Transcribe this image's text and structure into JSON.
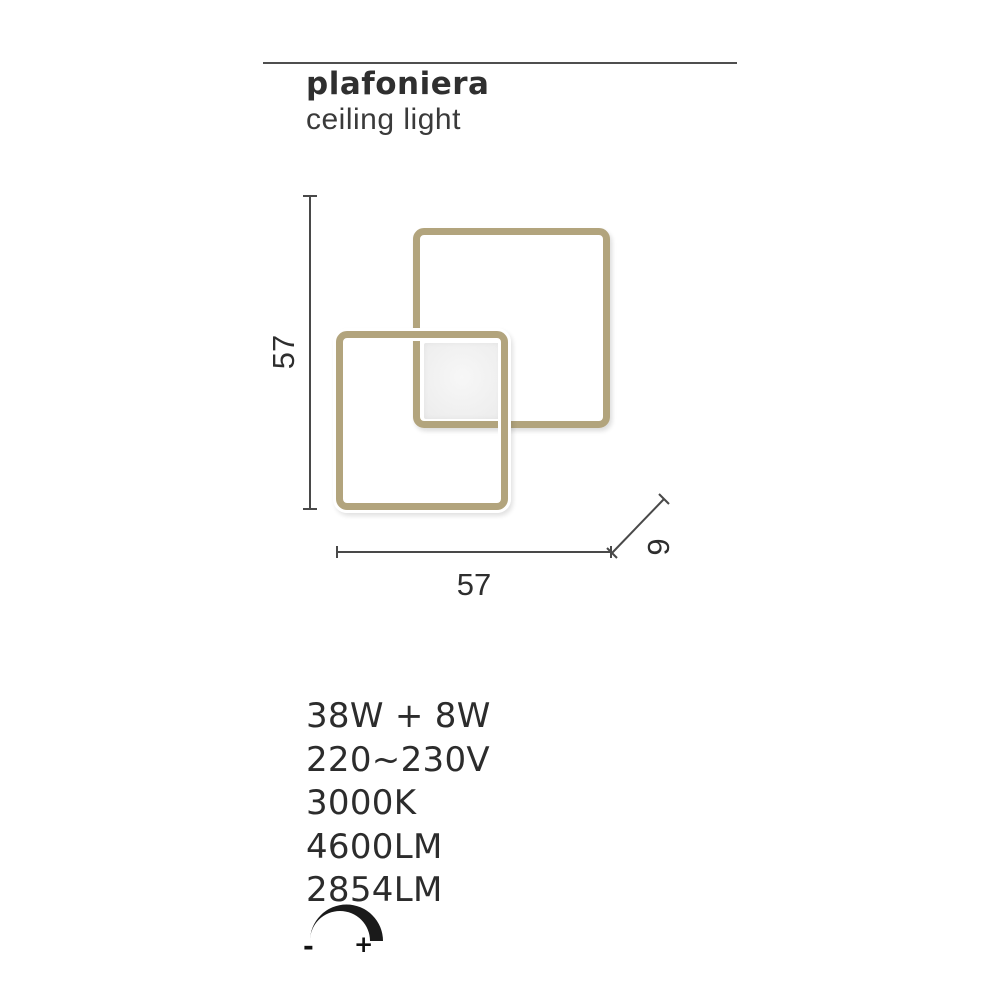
{
  "header": {
    "title": "plafoniera",
    "subtitle": "ceiling light"
  },
  "drawing": {
    "dimension_height_label": "57",
    "dimension_width_label": "57",
    "dimension_depth_label": "9"
  },
  "specs": [
    "38W + 8W",
    "220~230V",
    "3000K",
    "4600LM",
    "2854LM"
  ],
  "dimmer": {
    "minus_label": "-",
    "plus_label": "+"
  },
  "colors": {
    "frame_gold": "#b2a47d",
    "panel_gray": "#f0f0f0",
    "dimension_line_gray": "#494949",
    "text_dark": "#2c2c2c",
    "icon_black": "#1a1a1a"
  }
}
